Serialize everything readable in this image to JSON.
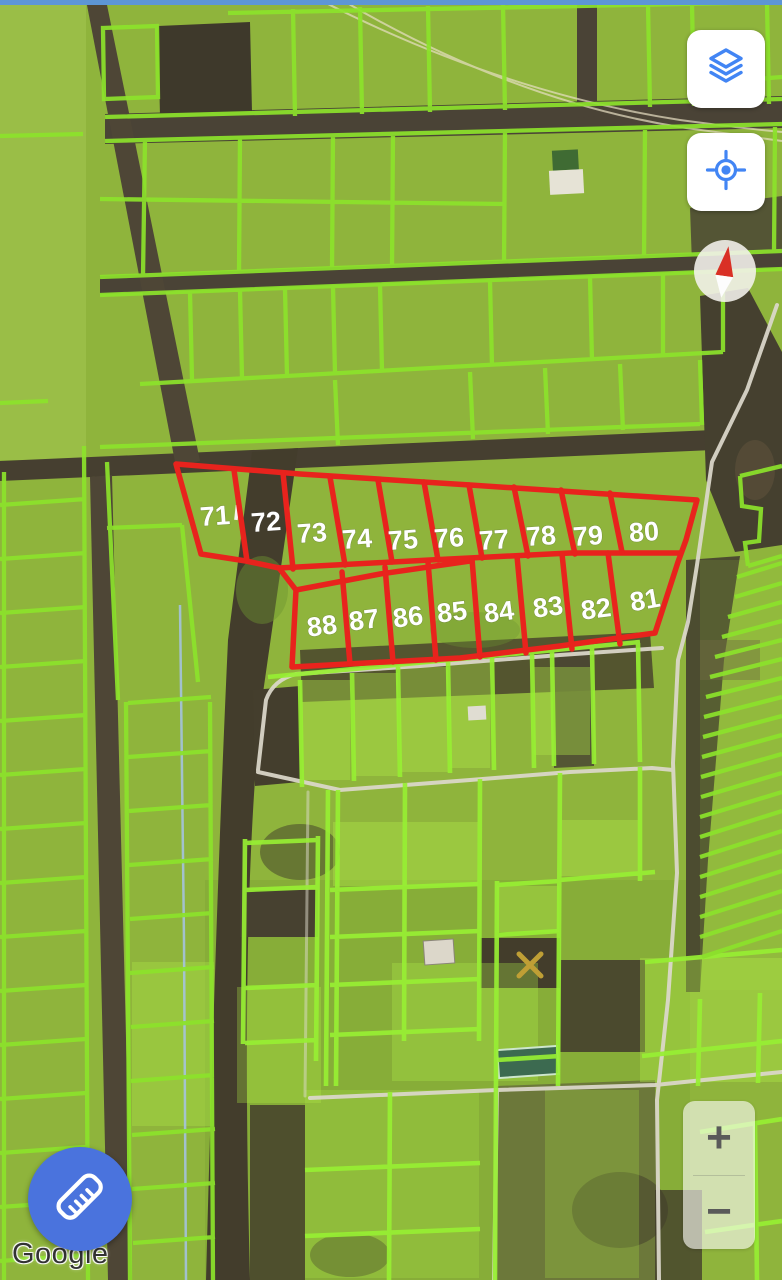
{
  "window": {
    "width": 782,
    "height": 1280,
    "view": "satellite-map"
  },
  "watermark": {
    "text": "Google"
  },
  "controls": {
    "layers_button": {
      "icon": "layers-icon"
    },
    "my_location_button": {
      "icon": "my-location-icon"
    },
    "compass": {
      "icon": "compass-needle-icon"
    },
    "zoom_in_label": "+",
    "zoom_out_label": "−",
    "measure_button": {
      "icon": "ruler-icon"
    }
  },
  "map": {
    "colors": {
      "parcel_outline_green": "#8ce32b",
      "highlight_outline_red": "#e8231d",
      "parcel_label_color": "#ffffff",
      "control_icon_blue": "#4285F4",
      "fab_blue": "#4a73dd",
      "compass_needle_red": "#d93025"
    },
    "highlighted_parcels": [
      {
        "label": "71",
        "x": 215,
        "y": 516,
        "rot": -4
      },
      {
        "label": "72",
        "x": 266,
        "y": 522,
        "rot": -4
      },
      {
        "label": "73",
        "x": 312,
        "y": 533,
        "rot": -4
      },
      {
        "label": "74",
        "x": 357,
        "y": 539,
        "rot": -4
      },
      {
        "label": "75",
        "x": 403,
        "y": 540,
        "rot": -4
      },
      {
        "label": "76",
        "x": 449,
        "y": 538,
        "rot": -4
      },
      {
        "label": "77",
        "x": 494,
        "y": 540,
        "rot": -4
      },
      {
        "label": "78",
        "x": 541,
        "y": 536,
        "rot": -4
      },
      {
        "label": "79",
        "x": 588,
        "y": 536,
        "rot": -4
      },
      {
        "label": "80",
        "x": 644,
        "y": 532,
        "rot": -4
      },
      {
        "label": "88",
        "x": 322,
        "y": 626,
        "rot": -7
      },
      {
        "label": "87",
        "x": 364,
        "y": 620,
        "rot": -7
      },
      {
        "label": "86",
        "x": 408,
        "y": 617,
        "rot": -7
      },
      {
        "label": "85",
        "x": 452,
        "y": 612,
        "rot": -7
      },
      {
        "label": "84",
        "x": 499,
        "y": 612,
        "rot": -7
      },
      {
        "label": "83",
        "x": 548,
        "y": 607,
        "rot": -7
      },
      {
        "label": "82",
        "x": 596,
        "y": 609,
        "rot": -7
      },
      {
        "label": "81",
        "x": 645,
        "y": 600,
        "rot": -10
      }
    ]
  }
}
